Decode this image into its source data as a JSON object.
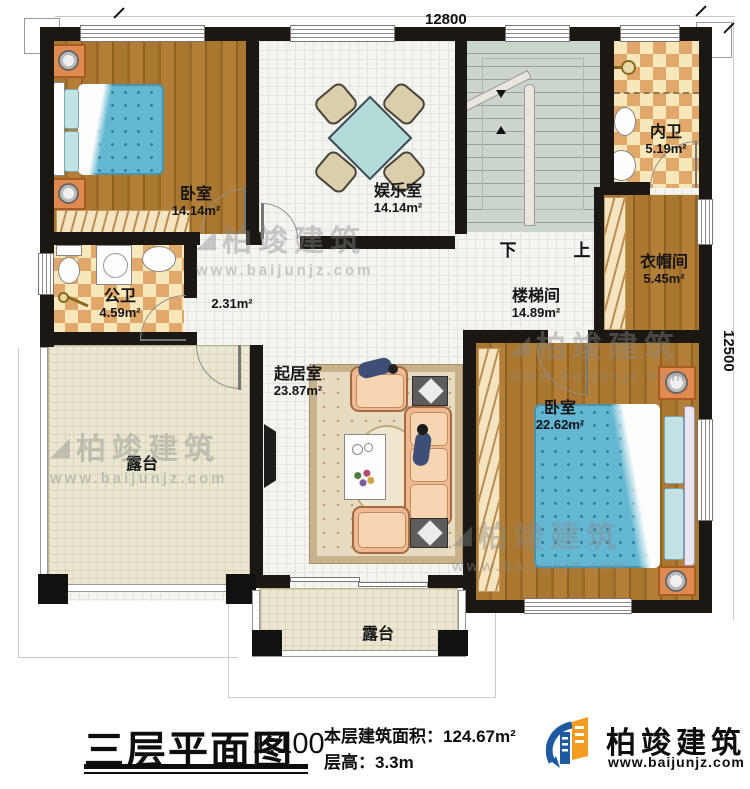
{
  "meta": {
    "plan_title": "三层平面图",
    "scale": "1:100",
    "area_label": "本层建筑面积：",
    "area_value": "124.67m²",
    "floor_height_label": "层高：",
    "floor_height_value": "3.3m"
  },
  "dimensions": {
    "top": "12800",
    "right": "12500"
  },
  "stairs": {
    "down": "下",
    "up": "上"
  },
  "rooms": {
    "bedroom1": {
      "name": "卧室",
      "area": "14.14m²"
    },
    "entertainment": {
      "name": "娱乐室",
      "area": "14.14m²"
    },
    "inner_bath": {
      "name": "内卫",
      "area": "5.19m²"
    },
    "cloakroom": {
      "name": "衣帽间",
      "area": "5.45m²"
    },
    "stairwell": {
      "name": "楼梯间",
      "area": "14.89m²"
    },
    "public_bath": {
      "name": "公卫",
      "area": "4.59m²"
    },
    "hallway": {
      "area": "2.31m²"
    },
    "living": {
      "name": "起居室",
      "area": "23.87m²"
    },
    "bedroom2": {
      "name": "卧室",
      "area": "22.62m²"
    },
    "terrace_left": {
      "name": "露台"
    },
    "terrace_bottom": {
      "name": "露台"
    }
  },
  "watermark": {
    "glyph": "◢",
    "title": "柏竣建筑",
    "url": "www.baijunjz.com"
  },
  "logo": {
    "title": "柏竣建筑",
    "url": "www.baijunjz.com"
  },
  "colors": {
    "wall": "#1b1712",
    "wood": "#aa7730",
    "tile_dark": "#e2a86a",
    "tile_light": "#f8e7bb",
    "stair_floor": "#ccd5cb",
    "terrace": "#ebe7d2",
    "bed_blue": "#64b7d3",
    "sofa_peach": "#efba93",
    "nightstand_orange": "#e08a50",
    "logo_blue": "#1e5aa0",
    "logo_orange": "#f59b20",
    "watermark_grey": "#8a8a8a"
  }
}
